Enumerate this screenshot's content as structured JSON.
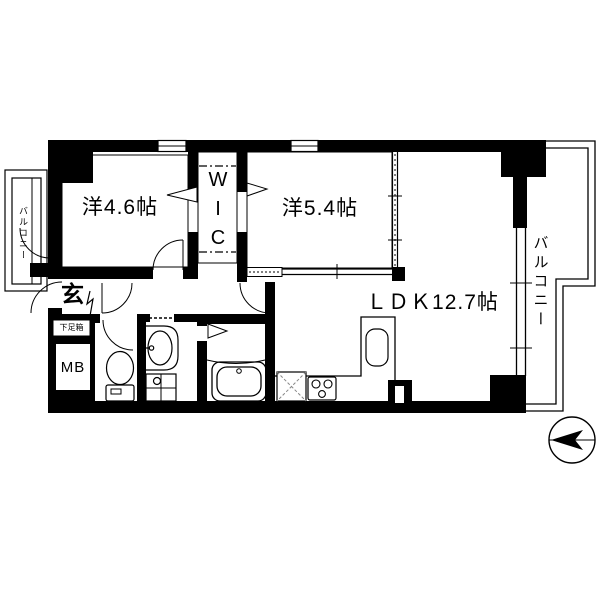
{
  "plan": {
    "title": "apartment-floor-plan",
    "labels": {
      "room_4_6": "洋4.6帖",
      "room_5_4": "洋5.4帖",
      "ldk": "ＬＤＫ12.7帖",
      "wic": "WIC",
      "balcony_left": "バルコニー",
      "balcony_right": "バルコニー",
      "entrance": "玄",
      "shoe_box": "下足箱",
      "meter_box": "MB"
    },
    "colors": {
      "wall": "#000000",
      "background": "#ffffff",
      "line": "#000000"
    }
  }
}
